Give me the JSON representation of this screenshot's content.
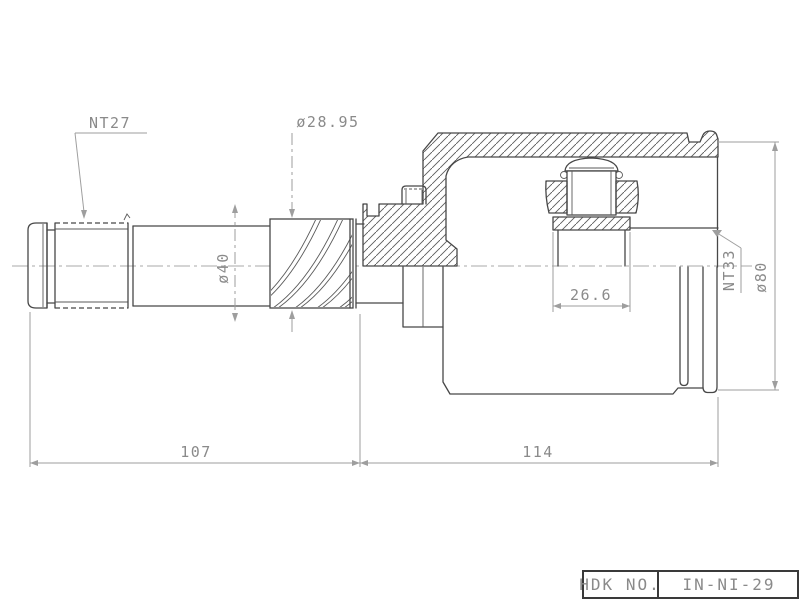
{
  "drawing_labels": {
    "nt27": "NT27",
    "dia_28_95": "ø28.95",
    "dia_40": "ø40",
    "width_26_6": "26.6",
    "nt33": "NT33",
    "dia_80": "ø80",
    "length_107": "107",
    "length_114": "114"
  },
  "title_block": {
    "label": "HDK NO.",
    "value": "IN-NI-29"
  },
  "colors": {
    "background": "#ffffff",
    "part_line": "#474747",
    "dimension_line": "#9e9e9e",
    "text": "#8a8a8a"
  }
}
